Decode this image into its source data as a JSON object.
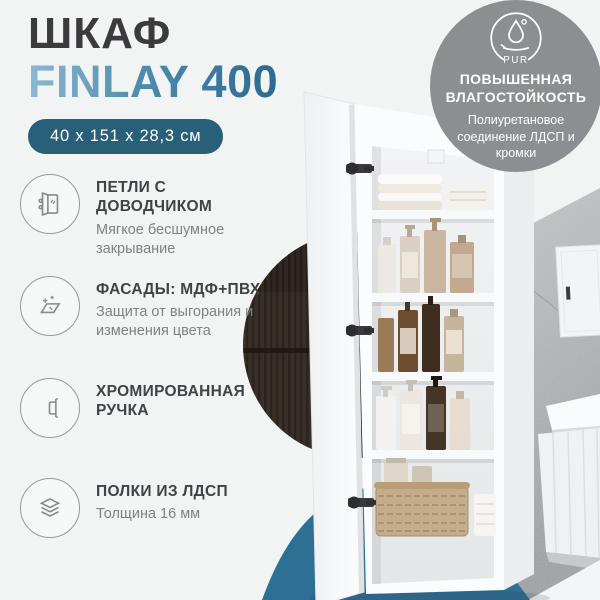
{
  "page": {
    "background": "#f2f3f3"
  },
  "header": {
    "title": "ШКАФ",
    "model": "FINLAY 400",
    "dimensions": "40 x 151 x 28,3 см",
    "title_color": "#3b3b3d",
    "model_gradient_start": "#8fb8d1",
    "model_gradient_end": "#2a6a90",
    "pill_bg": "#28607a",
    "pill_text_color": "#ffffff"
  },
  "badge": {
    "icon": "pur-droplet-icon",
    "icon_label": "PUR",
    "title_line1": "ПОВЫШЕННАЯ",
    "title_line2": "ВЛАГОСТОЙКОСТЬ",
    "subtitle": "Полиуретановое соединение ЛДСП и кромки",
    "bg": "#8c8f91",
    "text_color": "#ffffff"
  },
  "features": [
    {
      "icon": "door-hinge-icon",
      "title": "ПЕТЛИ С ДОВОДЧИКОМ",
      "subtitle": "Мягкое бесшумное закрывание"
    },
    {
      "icon": "sparkle-surface-icon",
      "title": "ФАСАДЫ: МДФ+ПВХ",
      "subtitle": "Защита от выгорания и изменения цвета"
    },
    {
      "icon": "door-handle-icon",
      "title": "ХРОМИРОВАННАЯ РУЧКА",
      "subtitle": ""
    },
    {
      "icon": "shelf-layers-icon",
      "title": "ПОЛКИ ИЗ ЛДСП",
      "subtitle": "Толщина 16 мм"
    }
  ],
  "scene": {
    "accent_blob_color": "#2e6f96",
    "dark_panel_circle_color": "#372d26",
    "concrete_wall_color": "#b6b9bb",
    "cabinet_color": "#fbfcfd"
  }
}
